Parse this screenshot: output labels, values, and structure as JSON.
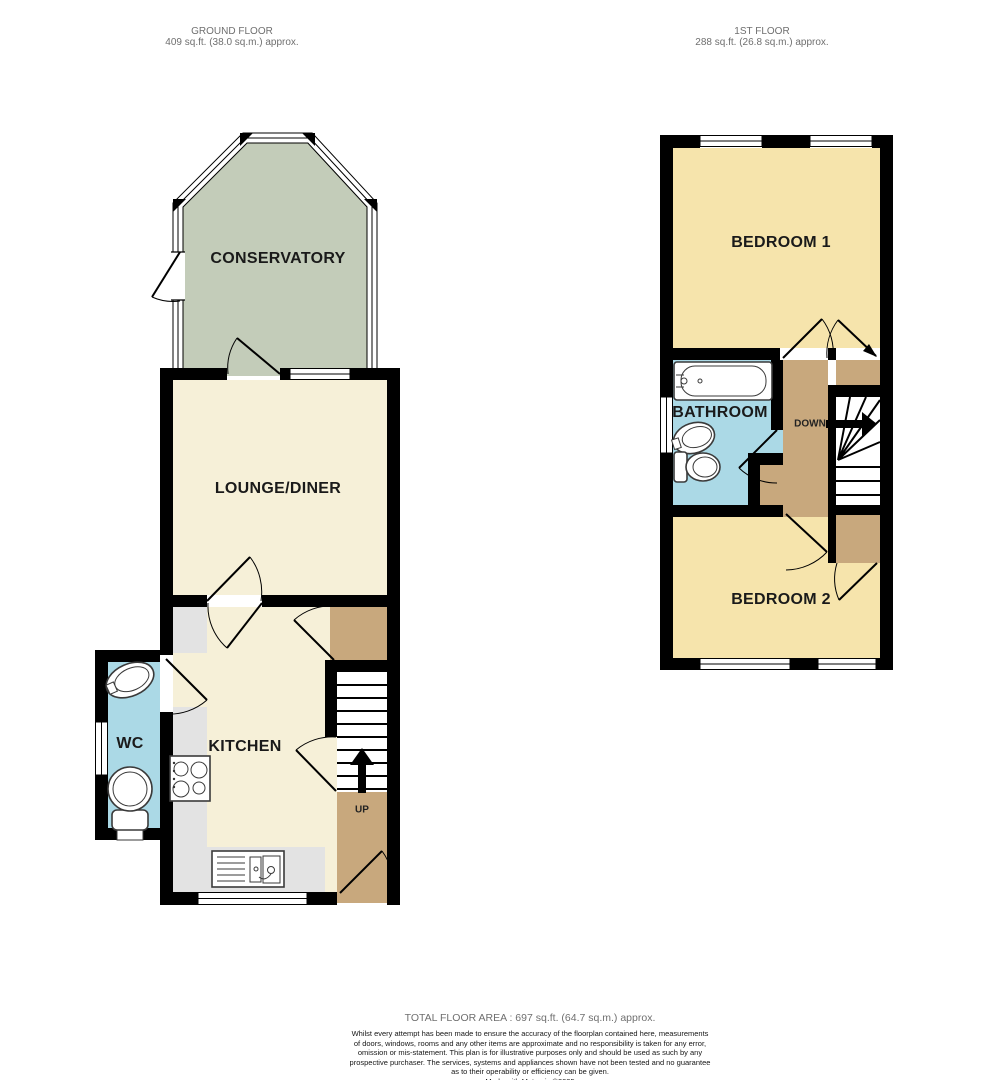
{
  "headers": {
    "ground": {
      "title": "GROUND FLOOR",
      "area": "409 sq.ft. (38.0 sq.m.) approx."
    },
    "first": {
      "title": "1ST FLOOR",
      "area": "288 sq.ft. (26.8 sq.m.) approx."
    }
  },
  "rooms": {
    "conservatory": "CONSERVATORY",
    "lounge_diner": "LOUNGE/DINER",
    "kitchen": "KITCHEN",
    "wc": "WC",
    "bedroom1": "BEDROOM 1",
    "bathroom": "BATHROOM",
    "bedroom2": "BEDROOM 2"
  },
  "stairs": {
    "up_label": "UP",
    "down_label": "DOWN"
  },
  "footer": {
    "total": "TOTAL FLOOR AREA : 697 sq.ft. (64.7 sq.m.) approx.",
    "disclaimer_lines": [
      "Whilst every attempt has been made to ensure the accuracy of the floorplan contained here, measurements",
      "of doors, windows, rooms and any other items are approximate and no responsibility is taken for any error,",
      "omission or mis-statement. This plan is for illustrative purposes only and should be used as such by any",
      "prospective purchaser. The services, systems and appliances shown have not been tested and no guarantee",
      "as to their operability or efficiency can be given."
    ],
    "credit": "Made with Metropix ©2025"
  },
  "colors": {
    "wall": "#000000",
    "room-ground": "#F6F0D8",
    "room-first": "#F6E4AC",
    "conservatory": "#C3CCB9",
    "wet": "#ABD9E6",
    "landing": "#C8A87D",
    "counter": "#E3E3E3",
    "label": "#1A1A1A",
    "muted": "#6F6F6F",
    "disclaimer": "#161616"
  }
}
